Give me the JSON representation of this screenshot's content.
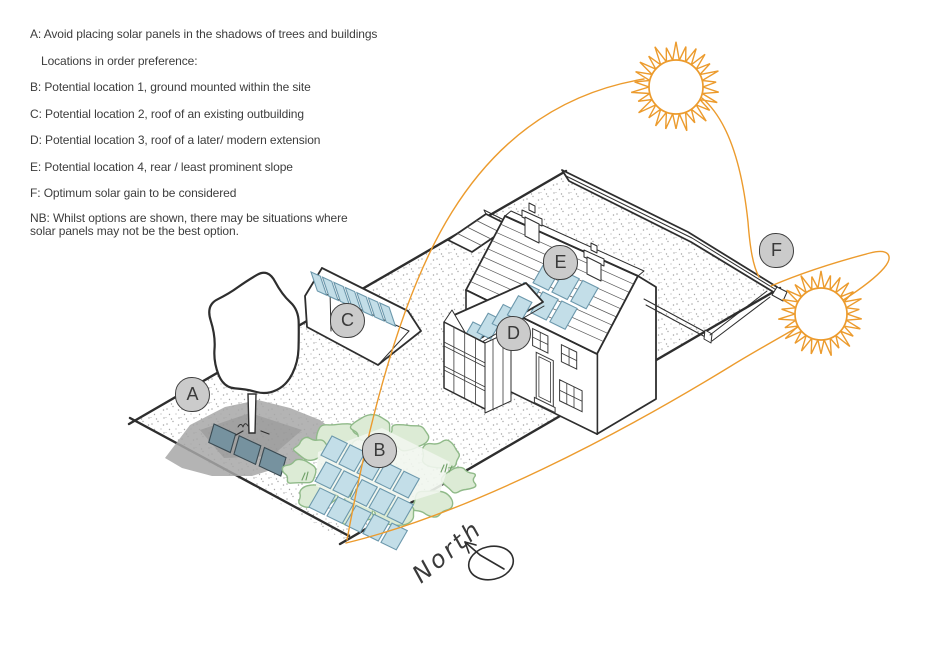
{
  "notes": {
    "line_a": "A: Avoid placing solar panels in the shadows of trees and buildings",
    "line_locations": "Locations in order preference:",
    "line_b": "B: Potential location 1, ground mounted within the site",
    "line_c": "C: Potential location 2, roof of an existing outbuilding",
    "line_d": "D: Potential location 3, roof of a later/ modern extension",
    "line_e": "E: Potential location 4, rear / least prominent slope",
    "line_f": "F: Optimum solar gain to be considered",
    "line_nb": "NB: Whilst options are shown, there may be situations where solar panels may not be the best option."
  },
  "diagram": {
    "north_label": "North",
    "location_markers": [
      {
        "letter": "A",
        "x": 192,
        "y": 394
      },
      {
        "letter": "B",
        "x": 379,
        "y": 450
      },
      {
        "letter": "C",
        "x": 347,
        "y": 320
      },
      {
        "letter": "D",
        "x": 513,
        "y": 333
      },
      {
        "letter": "E",
        "x": 560,
        "y": 262
      },
      {
        "letter": "F",
        "x": 776,
        "y": 250
      }
    ],
    "suns": [
      {
        "name": "morning-sun",
        "cx": 676,
        "cy": 87,
        "body_r": 27,
        "ray_r": 43,
        "rays": 26
      },
      {
        "name": "evening-sun",
        "cx": 821,
        "cy": 314,
        "body_r": 26,
        "ray_r": 41,
        "rays": 26
      }
    ],
    "colors": {
      "sun_orange": "#EC9B2D",
      "panel_blue": "#C3DEE8",
      "panel_blue_stroke": "#6C98AC",
      "shaded_panel": "#76929F",
      "shaded_panel_stroke": "#3A4A52",
      "shadow_gray": "#A7A7A7",
      "shrub_green": "#DCEBD5",
      "shrub_green_stroke": "#90BA89",
      "shrub_tuft": "#6FA067",
      "ink": "#2E2E2E",
      "ground_dot": "#8F8F8F",
      "label_circle_fill": "#CBCBCB",
      "label_circle_stroke": "#3E3E3E",
      "label_text": "#3A3A3A",
      "note_text": "#3D3D3D"
    }
  }
}
